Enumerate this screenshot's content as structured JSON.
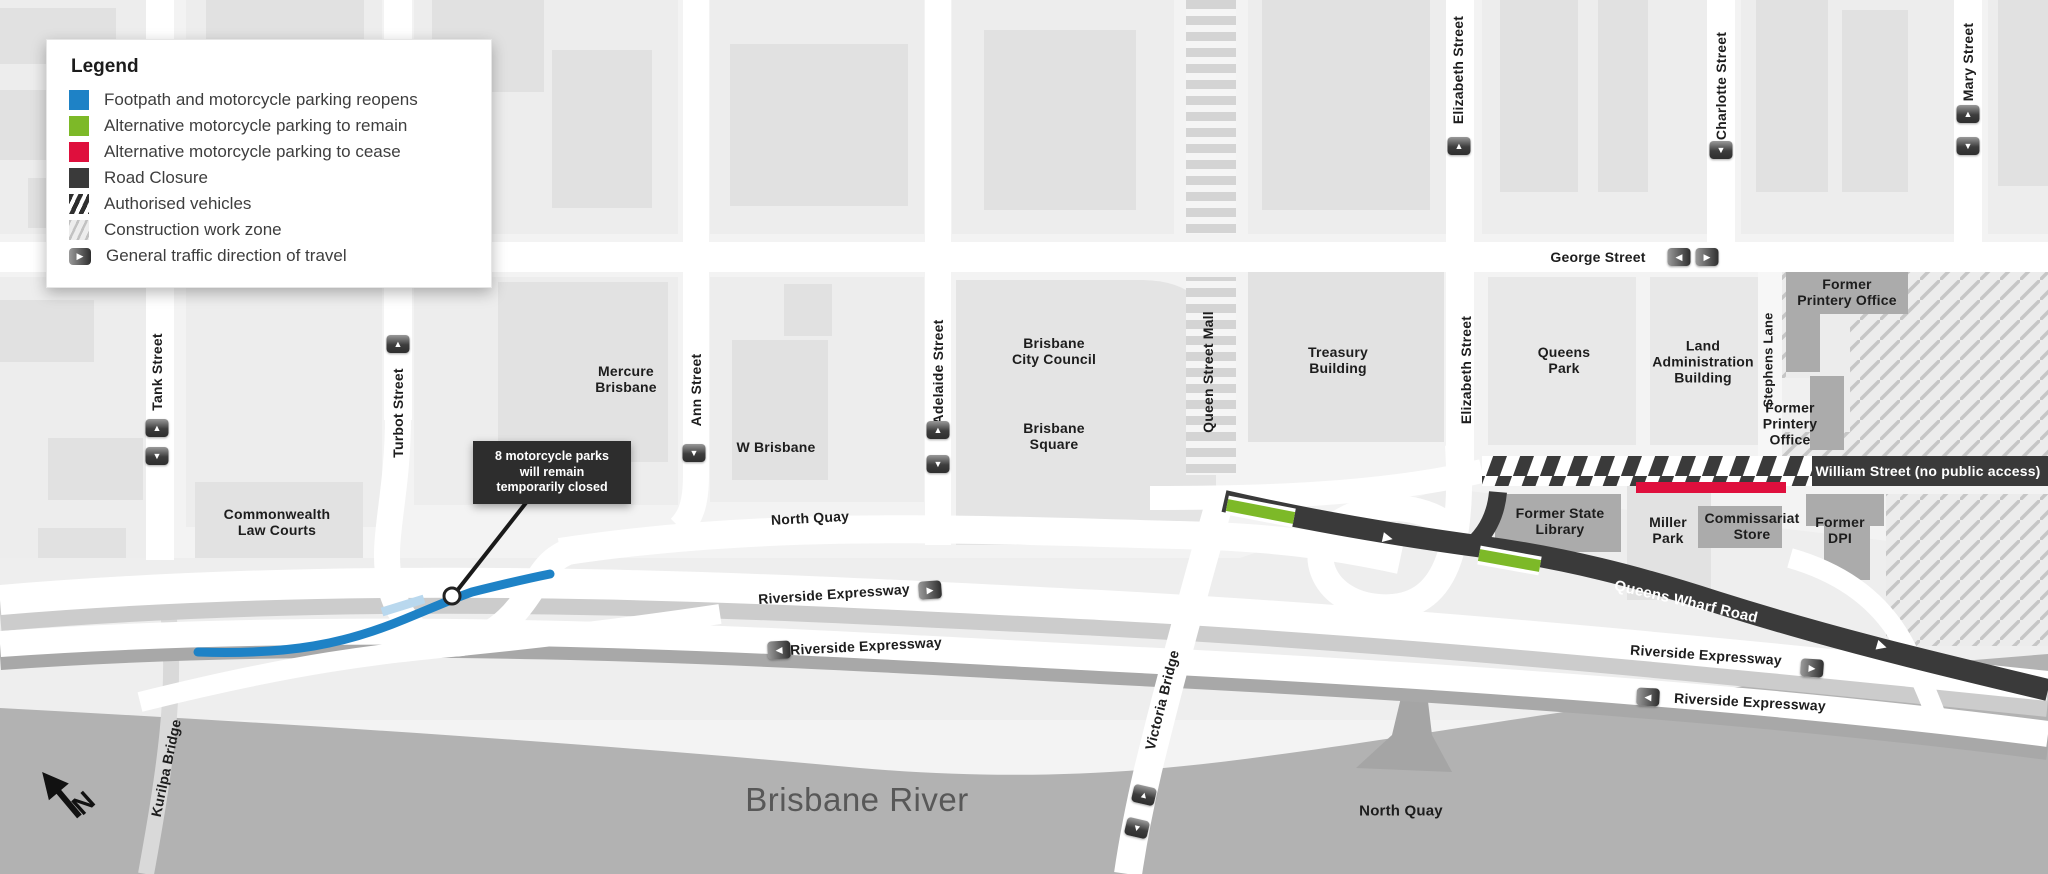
{
  "legend": {
    "title": "Legend",
    "items": [
      {
        "label": "Footpath and motorcycle parking reopens",
        "color": "#1e82c6",
        "swatch": "solid"
      },
      {
        "label": "Alternative motorcycle parking to remain",
        "color": "#7db928",
        "swatch": "solid"
      },
      {
        "label": "Alternative motorcycle parking to cease",
        "color": "#df0f3d",
        "swatch": "solid"
      },
      {
        "label": "Road Closure",
        "color": "#3a3a3a",
        "swatch": "solid"
      },
      {
        "label": "Authorised vehicles",
        "swatch": "dark-hatch"
      },
      {
        "label": "Construction work zone",
        "swatch": "light-hatch"
      },
      {
        "label": "General traffic direction of travel",
        "swatch": "direction-arrow"
      }
    ]
  },
  "callout": {
    "text": "8 motorcycle parks\nwill remain\ntemporarily closed"
  },
  "compass": {
    "north": "N"
  },
  "icons": {
    "up": "▲",
    "down": "▼",
    "left": "◀",
    "right": "▶"
  },
  "streets": {
    "tank": "Tank Street",
    "turbot": "Turbot Street",
    "ann": "Ann Street",
    "adelaide": "Adelaide Street",
    "queen_mall": "Queen Street Mall",
    "elizabeth": "Elizabeth Street",
    "charlotte": "Charlotte Street",
    "mary": "Mary Street",
    "george": "George Street",
    "stephens": "Stephens Lane",
    "north_quay": "North Quay",
    "riverside": "Riverside Expressway",
    "queens_wharf": "Queens Wharf Road",
    "william": "William Street (no public access)",
    "victoria": "Victoria Bridge",
    "kurilpa": "Kurilpa Bridge"
  },
  "places": {
    "law_courts": "Commonwealth\nLaw Courts",
    "mercure": "Mercure\nBrisbane",
    "w_brisbane": "W Brisbane",
    "city_council": "Brisbane\nCity Council",
    "brisbane_square": "Brisbane\nSquare",
    "treasury": "Treasury\nBuilding",
    "queens_park": "Queens\nPark",
    "land_admin": "Land\nAdministration\nBuilding",
    "printery_two_line": "Former\nPrintery Office",
    "printery_three_line": "Former\nPrintery\nOffice",
    "state_library": "Former State\nLibrary",
    "miller_park": "Miller\nPark",
    "commissariat": "Commissariat\nStore",
    "former_dpi": "Former\nDPI",
    "river": "Brisbane River"
  },
  "colors": {
    "reopens_blue": "#1e82c6",
    "remain_green": "#7db928",
    "cease_red": "#df0f3d",
    "closure_dark": "#3a3a3a",
    "river_gray": "#b2b2b2"
  }
}
